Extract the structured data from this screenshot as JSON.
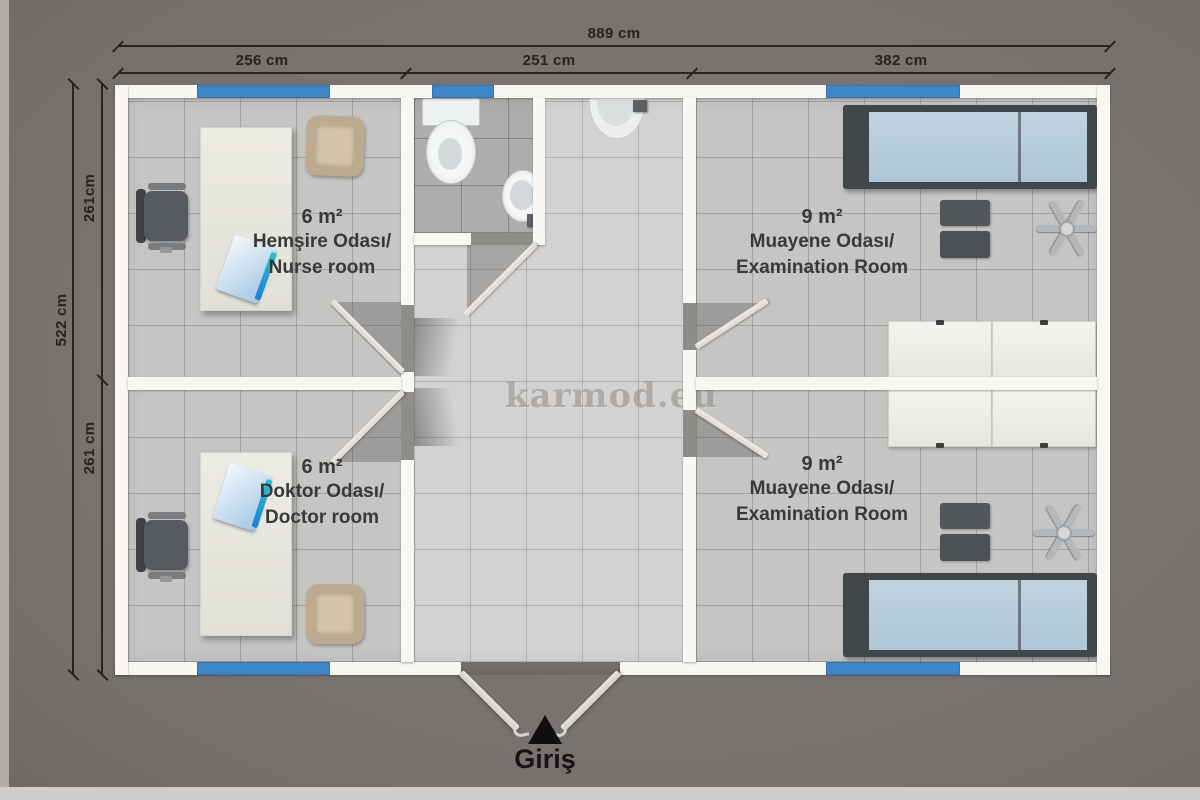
{
  "dimensions": {
    "top": {
      "overall": "889 cm",
      "segments": [
        "256 cm",
        "251 cm",
        "382 cm"
      ]
    },
    "left": {
      "overall": "522 cm",
      "segments": [
        "261cm",
        "261 cm"
      ]
    }
  },
  "rooms": [
    {
      "area": "6 m²",
      "name_tr": "Hemşire Odası/",
      "name_en": "Nurse room"
    },
    {
      "area": "6 m²",
      "name_tr": "Doktor Odası/",
      "name_en": "Doctor room"
    },
    {
      "area": "9 m²",
      "name_tr": "Muayene Odası/",
      "name_en": "Examination Room"
    },
    {
      "area": "9 m²",
      "name_tr": "Muayene Odası/",
      "name_en": "Examination Room"
    }
  ],
  "watermark": "karmod.eu",
  "entrance": {
    "label": "Giriş"
  },
  "colors": {
    "window_blue": "#3e86c8",
    "wall_white": "#f8f7f4",
    "background_gray": "#7c7674",
    "bed_mattress_blue": "#b6ccda",
    "dimension_line": "#29241f"
  }
}
